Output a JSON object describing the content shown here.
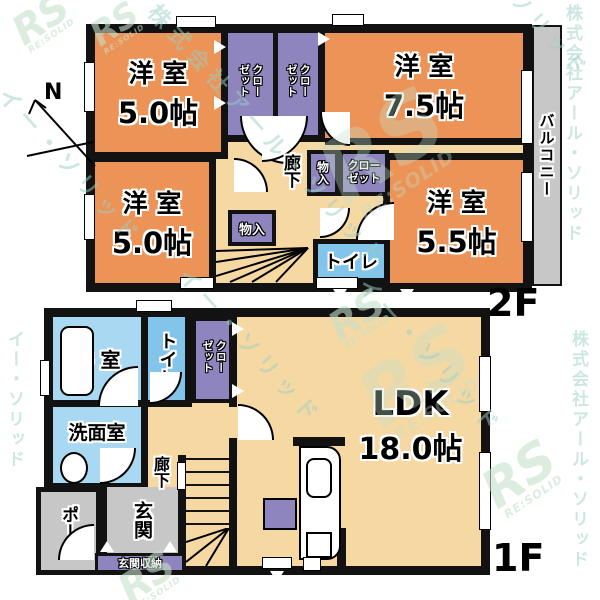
{
  "palette": {
    "wall": "#121212",
    "orange": "#EC9457",
    "cream": "#F6D8A3",
    "purple": "#8E85BE",
    "blue": "#82C4EA",
    "bath-blue": "#A9D9F2",
    "gray": "#C7C7C7",
    "wm-green": "#C5E0CA",
    "wm-teal": "#9BCFC4"
  },
  "compass": {
    "north": "N"
  },
  "floor2": {
    "floor_label": "2F",
    "room_nw": {
      "name": "洋 室",
      "size": "5.0帖"
    },
    "room_ne": {
      "name": "洋 室",
      "size": "7.5帖"
    },
    "room_sw": {
      "name": "洋 室",
      "size": "5.0帖"
    },
    "room_se": {
      "name": "洋 室",
      "size": "5.5帖"
    },
    "closet_top_left": "クローゼット",
    "closet_top_right": "クローゼット",
    "closet_mid": "クローゼット",
    "storage_mid": "物入",
    "storage_left": "物入",
    "hallway": "廊下",
    "toilet": "トイレ",
    "balcony": "バルコニー"
  },
  "floor1": {
    "floor_label": "1F",
    "bathroom": "浴 室",
    "toilet": "トイレ",
    "closet": "クローゼット",
    "washroom": "洗面室",
    "hallway": "廊下",
    "ldk_name": "LDK",
    "ldk_size": "18.0帖",
    "porch": "ポーチ",
    "entrance": "玄関",
    "entrance_storage": "玄関収納"
  },
  "watermarks": {
    "logo": "RS",
    "logo_sub": "RE:SOLID",
    "company": "株式会社アール・ソリッド",
    "company_alt": "イー・ソリッド"
  }
}
